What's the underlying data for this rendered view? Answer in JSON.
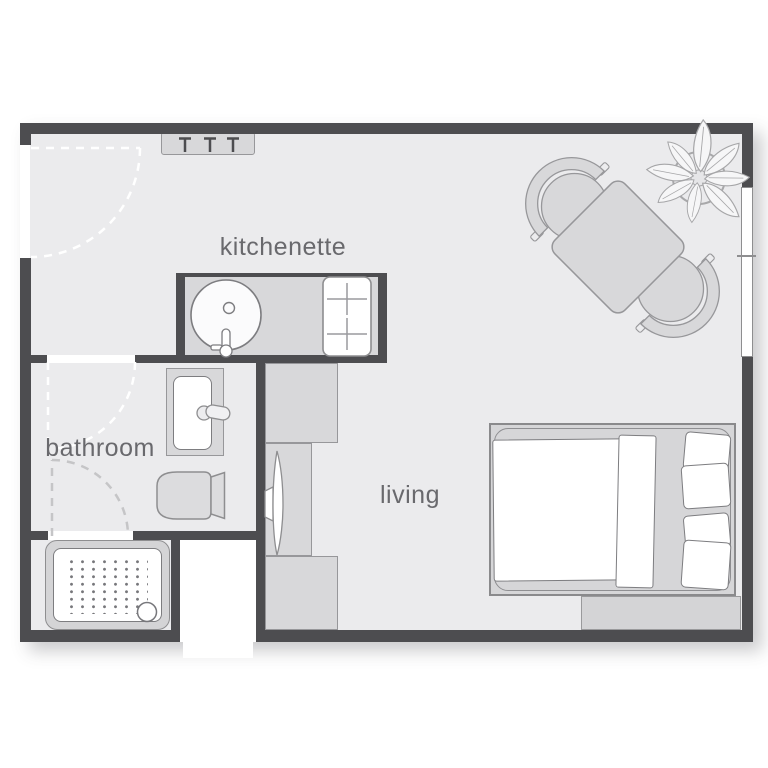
{
  "rooms": {
    "kitchenette": {
      "label": "kitchenette"
    },
    "bathroom": {
      "label": "bathroom"
    },
    "living": {
      "label": "living"
    }
  },
  "fixtures": [
    "entry-door-swing",
    "coat-rack",
    "kitchen-counter",
    "kitchen-sink",
    "kitchen-faucet",
    "cooktop-2-burner",
    "dining-table",
    "dining-chair",
    "dining-chair",
    "potted-plant",
    "window",
    "wardrobe-unit",
    "tv-unit",
    "flat-screen-tv",
    "storage-unit",
    "bathroom-door-swing",
    "wash-basin",
    "basin-faucet",
    "toilet",
    "shower-door-swing",
    "shower-tray",
    "shower-drain",
    "double-bed",
    "duvet",
    "pillows",
    "storage-bench"
  ],
  "palette": {
    "wall": "#4d4d50",
    "floor": "#ebebed",
    "furniture_fill": "#d8d8da",
    "furniture_stroke": "#97979a",
    "fixture_fill": "#ffffff",
    "fixture_stroke": "#7d7d80",
    "door_swing_primary": "#ffffff",
    "door_swing_secondary": "#c5c5c7",
    "label_text": "#69696d",
    "background": "#ffffff"
  }
}
